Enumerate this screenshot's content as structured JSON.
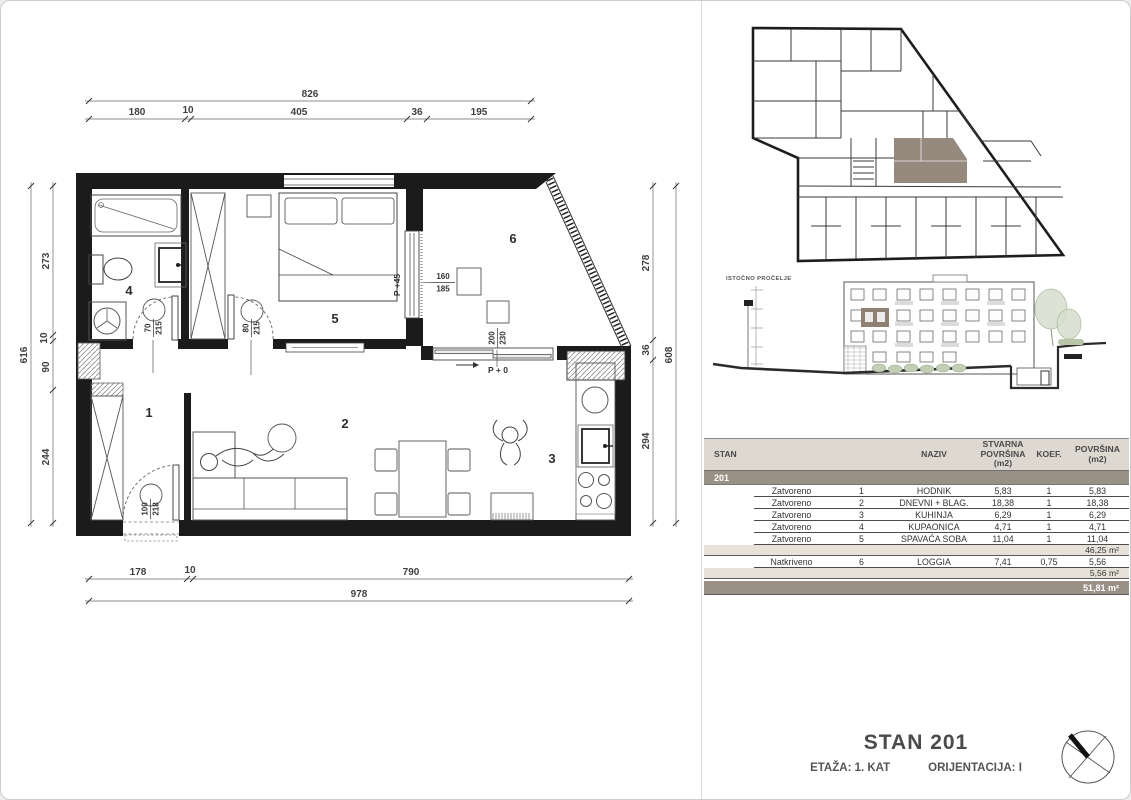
{
  "plan": {
    "rooms": {
      "hall": "1",
      "living": "2",
      "kitchen": "3",
      "bath": "4",
      "bedroom": "5",
      "loggia": "6"
    },
    "dims": {
      "top_total": "826",
      "top_1": "180",
      "top_2": "10",
      "top_3": "405",
      "top_4": "36",
      "top_5": "195",
      "left_total": "616",
      "left_1": "273",
      "left_2": "10",
      "left_3": "90",
      "left_4": "244",
      "right_total": "608",
      "right_1": "278",
      "right_2": "36",
      "right_3": "294",
      "bottom_total": "978",
      "bottom_1": "178",
      "bottom_2": "10",
      "bottom_3": "790"
    },
    "doors": {
      "bath_w": "70",
      "bath_h": "215",
      "bedroom_w": "80",
      "bedroom_h": "215",
      "entry_w": "100",
      "entry_h": "218",
      "loggia_window_w": "160",
      "loggia_window_h": "185",
      "loggia_door_w": "200",
      "loggia_door_h": "230"
    },
    "levels": {
      "loggia": "P +45",
      "terrace": "P + 0"
    }
  },
  "elevation": {
    "label": "ISTOČNO PROČELJE"
  },
  "table": {
    "headers": {
      "stan": "STAN",
      "naziv": "NAZIV",
      "stvarna": "STVARNA POVRŠINA (m2)",
      "koef": "KOEF.",
      "povrsina": "POVRŠINA (m2)"
    },
    "unit": "201",
    "rows": [
      {
        "type": "Zatvoreno",
        "num": "1",
        "naziv": "HODNIK",
        "stvarna": "5,83",
        "koef": "1",
        "povrsina": "5,83"
      },
      {
        "type": "Zatvoreno",
        "num": "2",
        "naziv": "DNEVNI + BLAG.",
        "stvarna": "18,38",
        "koef": "1",
        "povrsina": "18,38"
      },
      {
        "type": "Zatvoreno",
        "num": "3",
        "naziv": "KUHINJA",
        "stvarna": "6,29",
        "koef": "1",
        "povrsina": "6,29"
      },
      {
        "type": "Zatvoreno",
        "num": "4",
        "naziv": "KUPAONICA",
        "stvarna": "4,71",
        "koef": "1",
        "povrsina": "4,71"
      },
      {
        "type": "Zatvoreno",
        "num": "5",
        "naziv": "SPAVAĆA SOBA",
        "stvarna": "11,04",
        "koef": "1",
        "povrsina": "11,04"
      }
    ],
    "subtotal_closed": "46,25 m²",
    "row_open": {
      "type": "Natkriveno",
      "num": "6",
      "naziv": "LOGGIA",
      "stvarna": "7,41",
      "koef": "0,75",
      "povrsina": "5,56"
    },
    "subtotal_open": "5,56 m²",
    "total": "51,81 m²"
  },
  "title_block": {
    "title": "STAN 201",
    "etaza": "ETAŽA: 1. KAT",
    "orijentacija": "ORIJENTACIJA: I"
  }
}
